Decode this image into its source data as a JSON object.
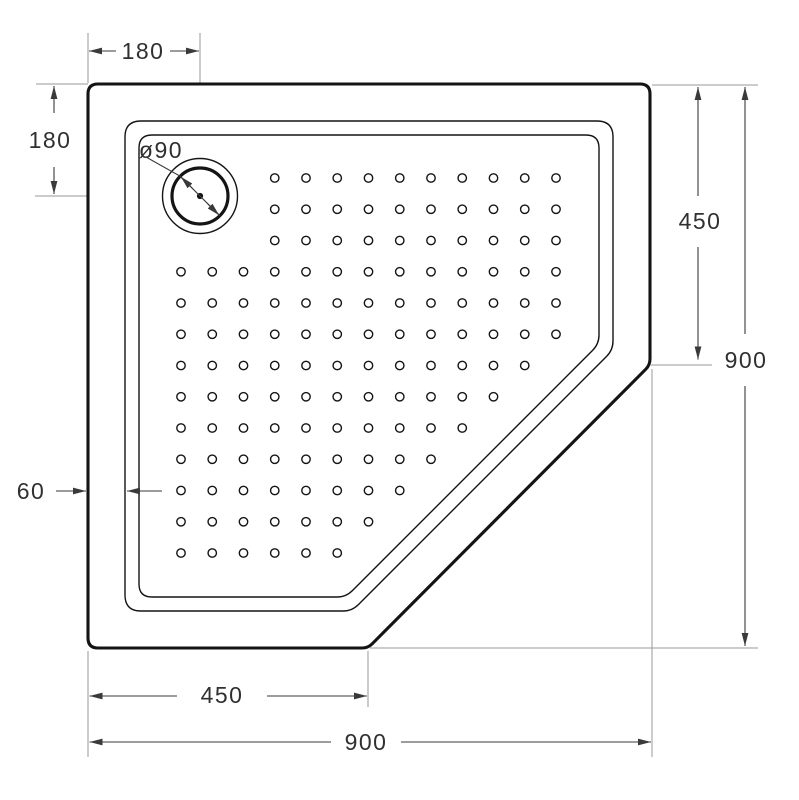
{
  "drawing": {
    "description": "Pentagonal shower tray technical drawing, top view",
    "colors": {
      "background": "#ffffff",
      "drawing_line": "#141414",
      "dimension_line": "#3a3a3a",
      "extension_line": "#9a9a9a",
      "label_text": "#303030"
    },
    "dimensions": {
      "drain_offset_x": "180",
      "drain_offset_y": "180",
      "drain_diameter": "ø90",
      "right_straight_edge": "450",
      "overall_height": "900",
      "rim_width": "60",
      "bottom_straight_edge": "450",
      "overall_width": "900"
    }
  }
}
